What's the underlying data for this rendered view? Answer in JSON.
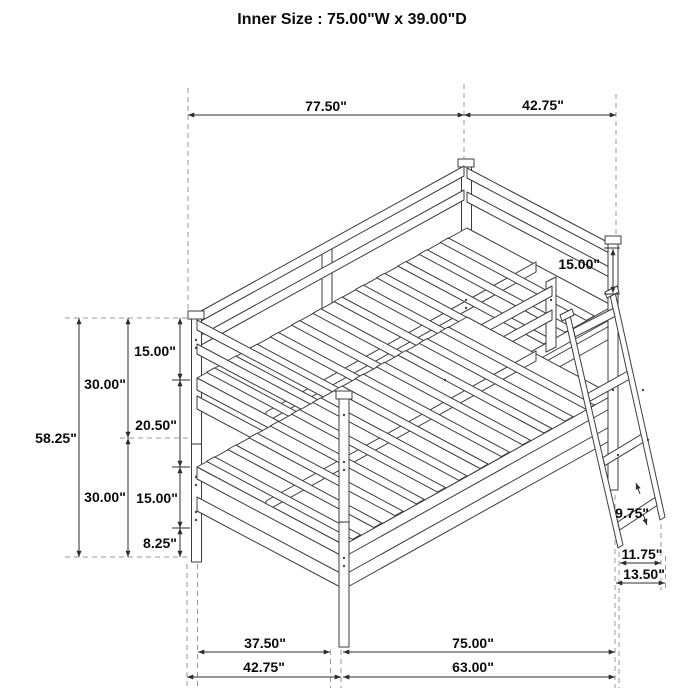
{
  "title": "Inner Size : 75.00\"W x 39.00\"D",
  "dims": {
    "top_width": "77.50\"",
    "top_depth": "42.75\"",
    "guard_height": "15.00\"",
    "total_height": "58.25\"",
    "upper_section": "30.00\"",
    "lower_section": "30.00\"",
    "upper_rail": "15.00\"",
    "clearance": "20.50\"",
    "lower_rail": "15.00\"",
    "under_clearance": "8.25\"",
    "rung_spacing": "9.75\"",
    "ladder_feet_inner": "11.75\"",
    "ladder_feet_outer": "13.50\"",
    "bottom_inner_depth": "37.50\"",
    "bottom_inner_width": "75.00\"",
    "bottom_outer_depth": "42.75\"",
    "bottom_lower_width": "63.00\""
  }
}
